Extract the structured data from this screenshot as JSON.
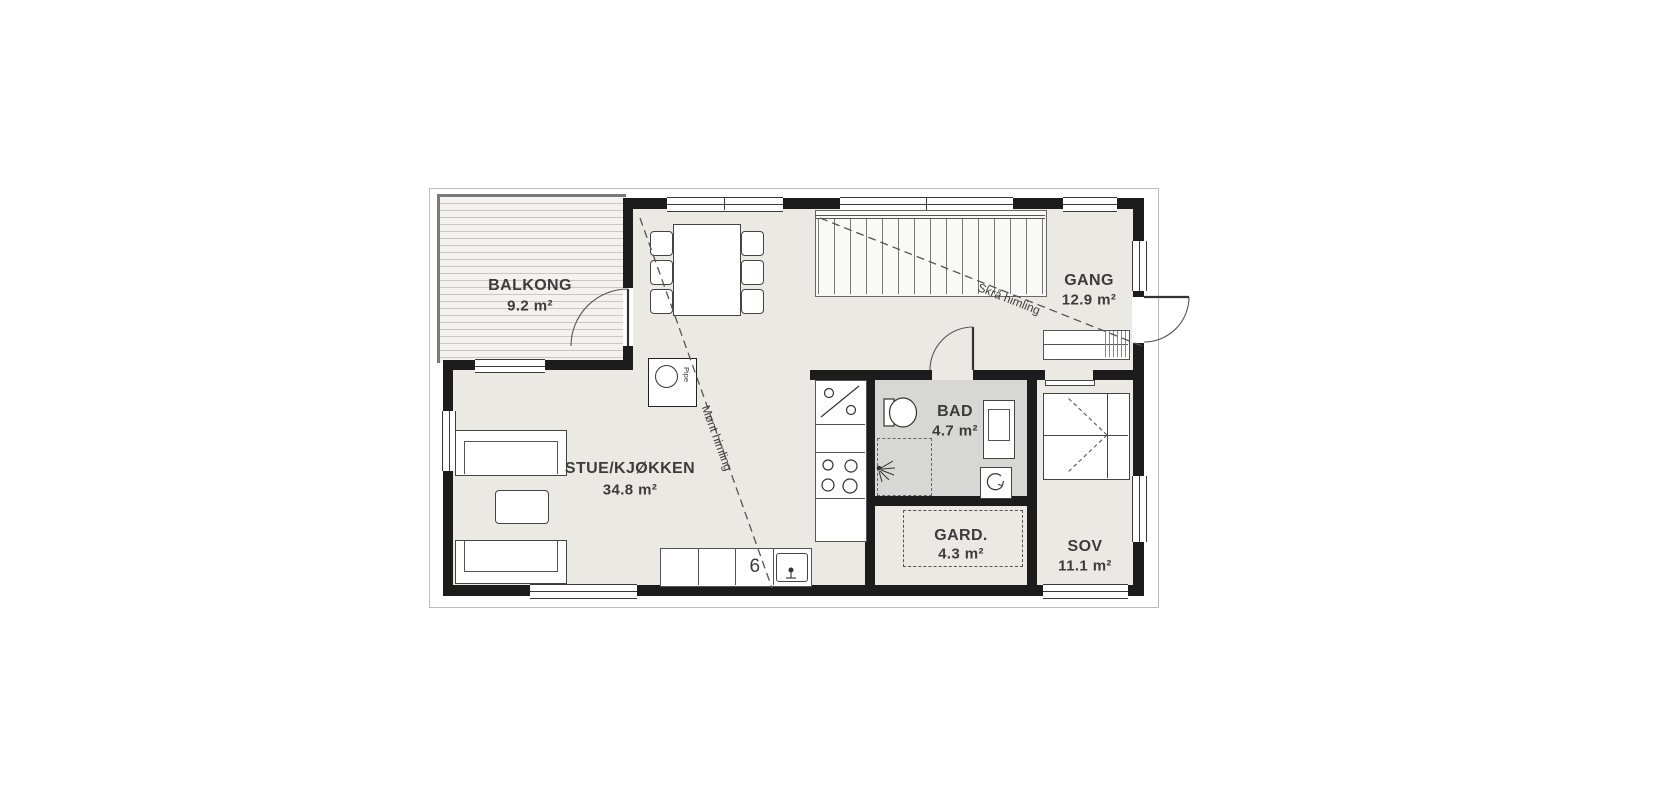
{
  "plan": {
    "rooms": [
      {
        "id": "balkong",
        "name": "BALKONG",
        "area": "9.2 m²"
      },
      {
        "id": "stue",
        "name": "STUE/KJØKKEN",
        "area": "34.8 m²"
      },
      {
        "id": "gang",
        "name": "GANG",
        "area": "12.9 m²"
      },
      {
        "id": "bad",
        "name": "BAD",
        "area": "4.7 m²"
      },
      {
        "id": "gard",
        "name": "GARD.",
        "area": "4.3 m²"
      },
      {
        "id": "sov",
        "name": "SOV",
        "area": "11.1 m²"
      }
    ],
    "annotations": {
      "ceiling_line_1": "Mønt himling",
      "ceiling_line_2": "Skrå himling",
      "chimney": "Pipe"
    },
    "symbols": {
      "stove": "6"
    },
    "colors": {
      "wall": "#1c1c1c",
      "floor": "#ebe9e4",
      "bath_floor": "#d7d7d5",
      "line": "#3a3a3a",
      "balcony_stripe": "#c9c7c2"
    }
  }
}
